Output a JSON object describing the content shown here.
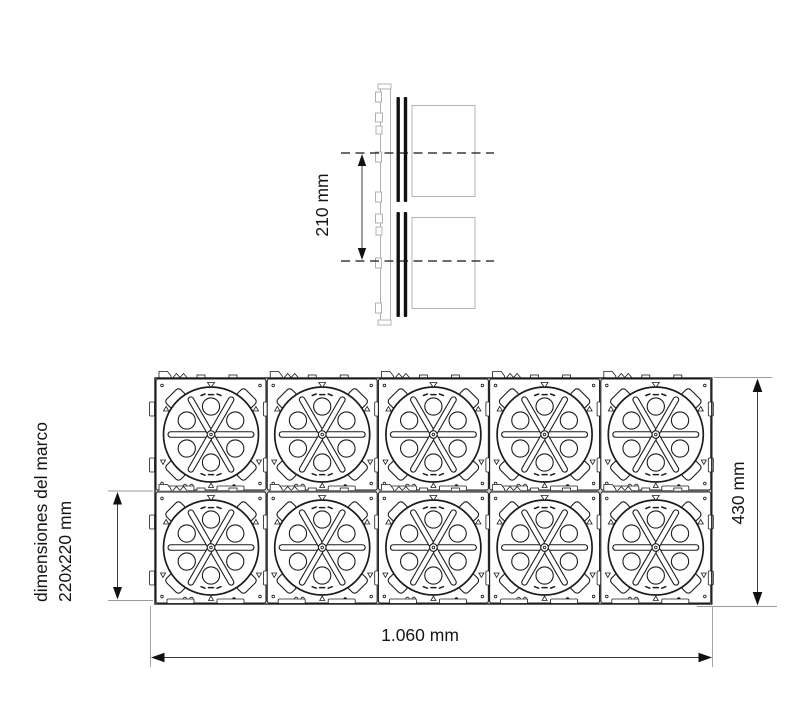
{
  "drawing": {
    "side_view": {
      "spacing_label": "210 mm"
    },
    "plan_view": {
      "rows": 2,
      "columns": 5,
      "module_count": 10,
      "width_label": "1.060 mm",
      "height_label": "430 mm",
      "frame_label_line1": "dimensiones del marco",
      "frame_label_line2": "220x220 mm"
    },
    "colors": {
      "background": "#ffffff",
      "line": "#1c1c1c",
      "dimension": "#3c3c3c",
      "light_gray": "#b0b0b0"
    }
  }
}
